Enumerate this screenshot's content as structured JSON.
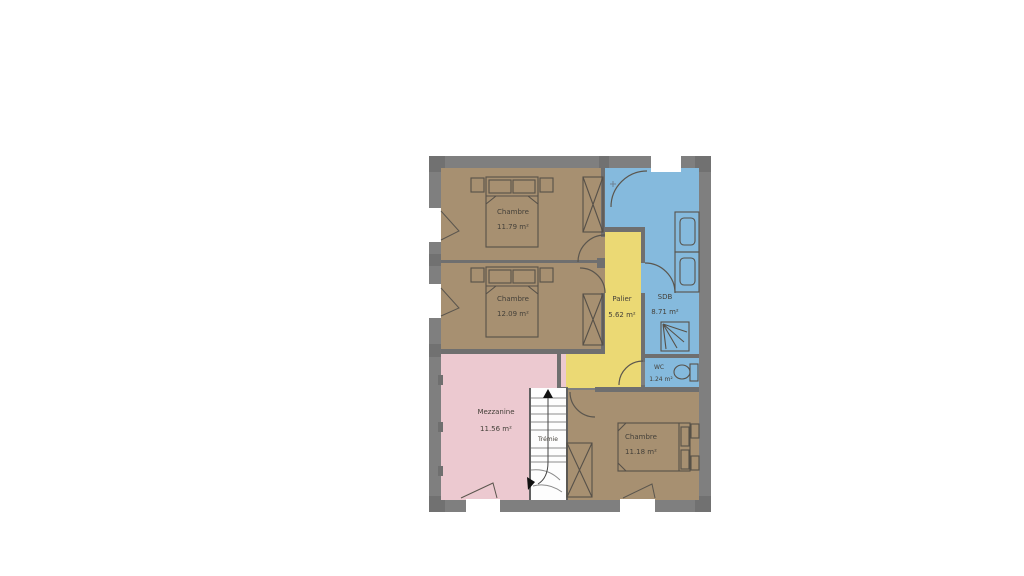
{
  "plan": {
    "title": "floor-plan-upper-level",
    "rooms": [
      {
        "name": "Chambre",
        "area": "11.79 m²"
      },
      {
        "name": "Chambre",
        "area": "12.09 m²"
      },
      {
        "name": "Palier",
        "area": "5.62 m²"
      },
      {
        "name": "SDB",
        "area": "8.71 m²"
      },
      {
        "name": "WC",
        "area": "1.24 m²"
      },
      {
        "name": "Mezzanine",
        "area": "11.56 m²"
      },
      {
        "name": "Chambre",
        "area": "11.18 m²"
      }
    ],
    "stairwell_label": "Trémie",
    "colors": {
      "wall": "#7f7f7f",
      "wall_corner": "#717171",
      "bedroom": "#a79071",
      "landing": "#ebd974",
      "bathroom": "#85badd",
      "mezzanine": "#ecc9d0",
      "stairs": "#fdfdfd"
    }
  }
}
